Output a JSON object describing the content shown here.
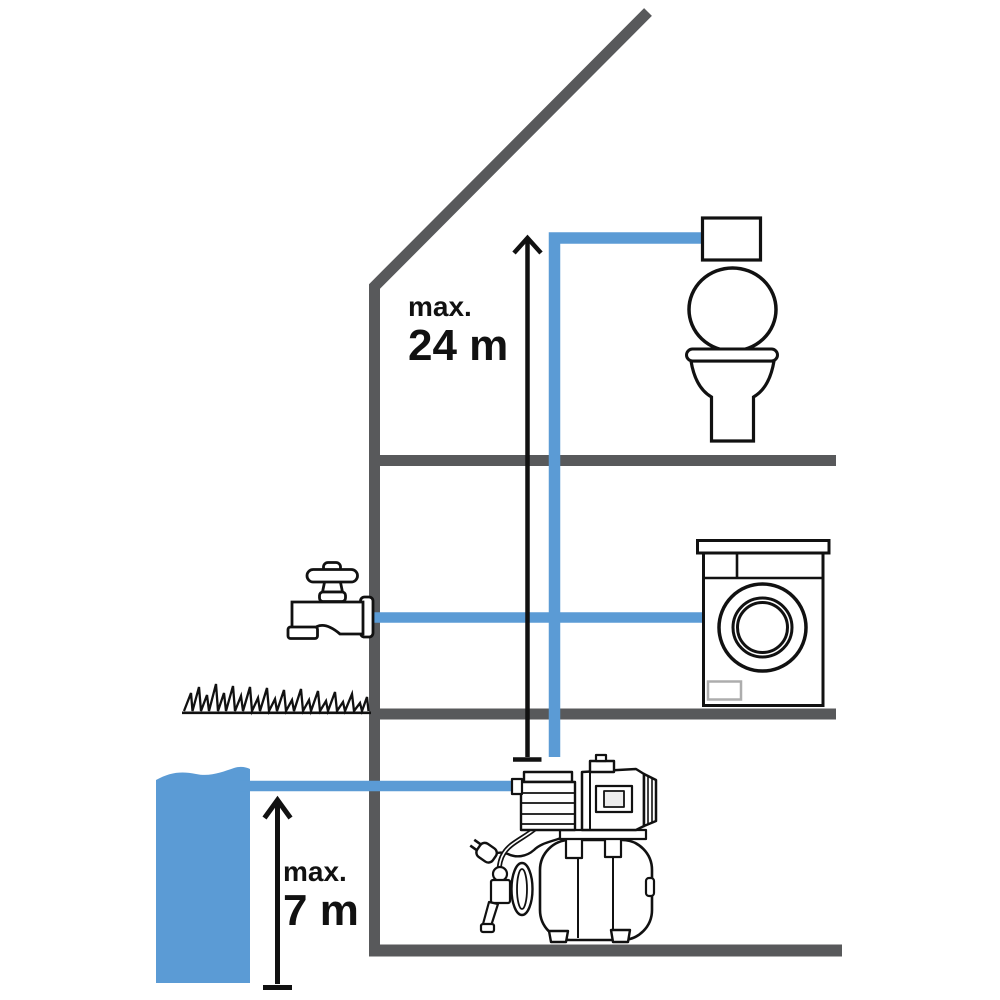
{
  "diagram": {
    "labels": {
      "delivery_head": {
        "prefix": "max.",
        "value": "24 m"
      },
      "suction_head": {
        "prefix": "max.",
        "value": "7 m"
      }
    },
    "colors": {
      "pipe_blue": "#5B9BD5",
      "structure_gray": "#58595B",
      "outline_black": "#111111"
    },
    "icons": [
      "house-wall-roof",
      "toilet-icon",
      "washing-machine-icon",
      "garden-tap-icon",
      "grass-icon",
      "water-source",
      "domestic-waterworks-pump-icon",
      "delivery-head-arrow",
      "suction-head-arrow",
      "water-pipe"
    ]
  }
}
